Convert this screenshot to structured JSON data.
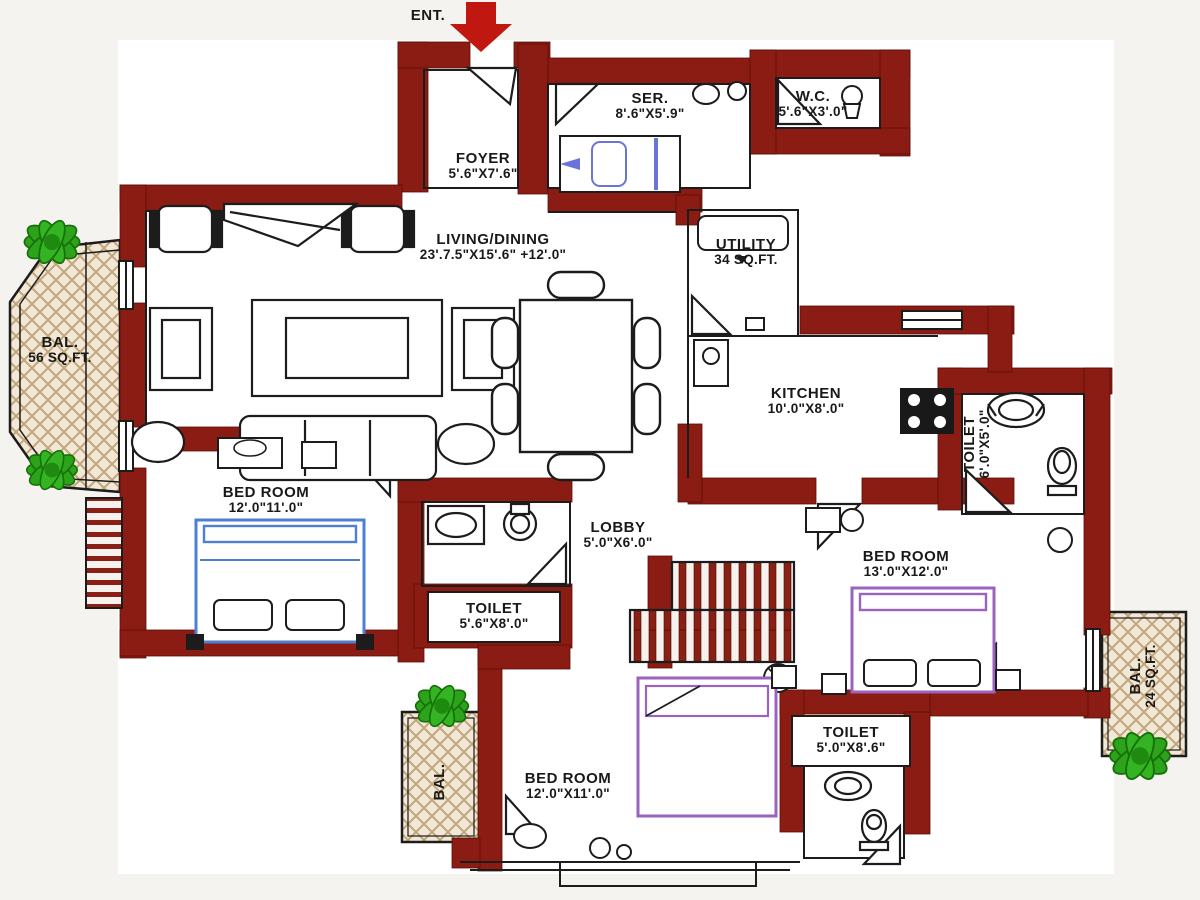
{
  "title": "Apartment Floor Plan",
  "colors": {
    "wall": "#8a1c13",
    "entry_arrow_red": "#c01710",
    "line_black": "#1c1c1c",
    "balcony_fill": "#f2e8d5",
    "hatch_line": "#bfa67d",
    "plant_green": "#2da31c",
    "bed_blue": "#4f7fd0",
    "bed_purple": "#9a63c0",
    "ser_bed_blue": "#6a74d8",
    "background": "#f5f3f0"
  },
  "labels": {
    "entrance": {
      "name": "ENT."
    },
    "foyer": {
      "name": "FOYER",
      "dims": "5'.6\"X7'.6\""
    },
    "servant": {
      "name": "SER.",
      "dims": "8'.6\"X5'.9\""
    },
    "wc": {
      "name": "W.C.",
      "dims": "5'.6\"X3'.0\""
    },
    "living_dining": {
      "name": "LIVING/DINING",
      "dims": "23'.7.5\"X15'.6\" +12'.0\""
    },
    "utility": {
      "name": "UTILITY",
      "dims": "34 SQ.FT."
    },
    "kitchen": {
      "name": "KITCHEN",
      "dims": "10'.0\"X8'.0\""
    },
    "bedroom_left": {
      "name": "BED ROOM",
      "dims": "12'.0\"11'.0\""
    },
    "lobby": {
      "name": "LOBBY",
      "dims": "5'.0\"X6'.0\""
    },
    "toilet_mid": {
      "name": "TOILET",
      "dims": "5'.6\"X8'.0\""
    },
    "bedroom_right": {
      "name": "BED ROOM",
      "dims": "13'.0\"X12'.0\""
    },
    "toilet_bottom": {
      "name": "TOILET",
      "dims": "5'.0\"X8'.6\""
    },
    "bedroom_bottom": {
      "name": "BED ROOM",
      "dims": "12'.0\"X11'.0\""
    },
    "balcony_left": {
      "name": "BAL.",
      "dims": "56 SQ.FT."
    },
    "toilet_right": {
      "name": "TOILET",
      "dims": "6'.0\"X5'.0\""
    },
    "balcony_right": {
      "name": "BAL.",
      "dims": "24 SQ.FT."
    },
    "balcony_bottom_left": {
      "name": "BAL.",
      "dims": ""
    }
  }
}
